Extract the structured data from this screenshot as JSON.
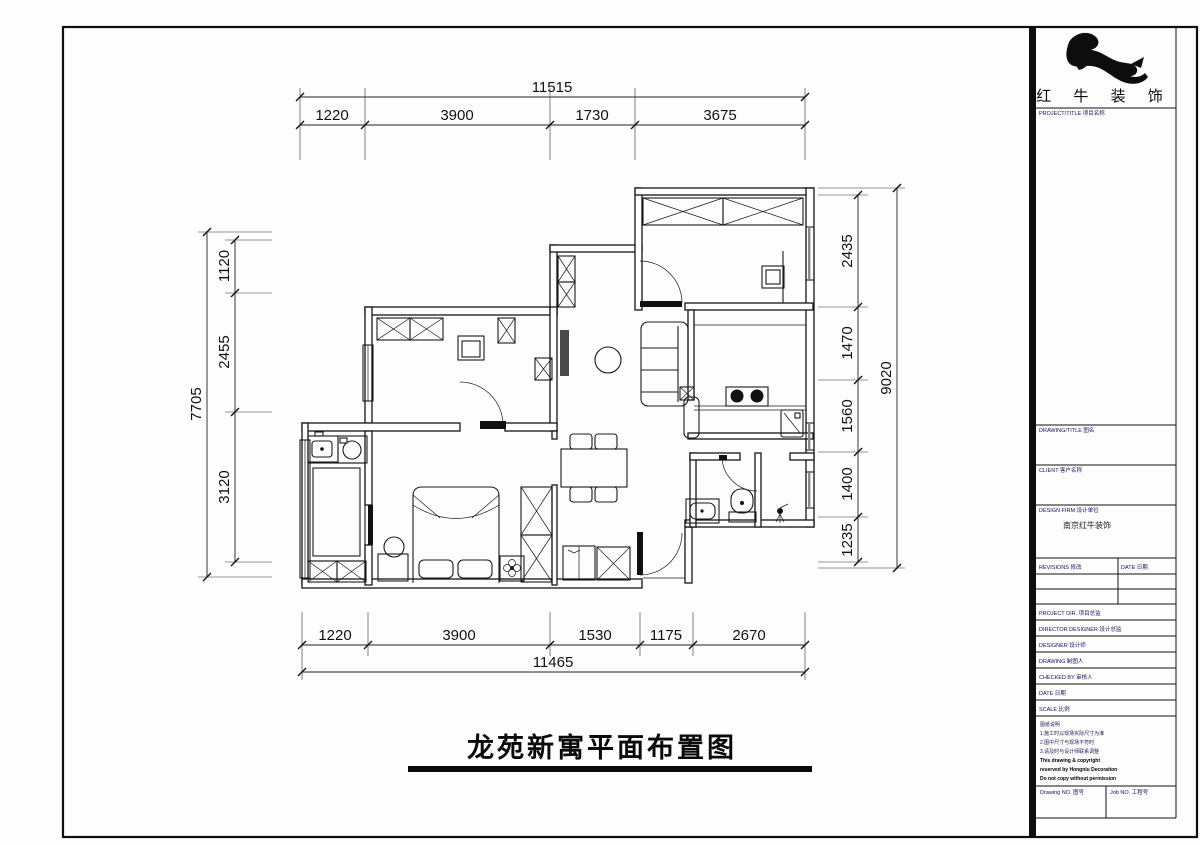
{
  "plan_title": "龙苑新寓平面布置图",
  "dims": {
    "top": {
      "total": "11515",
      "segments": [
        "1220",
        "3900",
        "1730",
        "3675"
      ]
    },
    "bottom": {
      "total": "11465",
      "segments": [
        "1220",
        "3900",
        "1530",
        "1175",
        "2670"
      ]
    },
    "left": {
      "total": "7705",
      "segments": [
        "1120",
        "2455",
        "3120"
      ]
    },
    "right": {
      "total": "9020",
      "segments": [
        "2435",
        "1470",
        "1560",
        "1400",
        "1235"
      ]
    }
  },
  "title_block": {
    "brand_text": "红 牛 装 饰",
    "project_title_label": "PROJECT/TITLE 项目名称",
    "drawing_title_label": "DRAWING/TITLE 图名",
    "client_label": "CLIENT 客户名称",
    "design_firm_label": "DESIGN FIRM 设计单位",
    "design_firm_value": "南京红牛装饰",
    "revisions_label": "REVISIONS 修改",
    "date_col_label": "DATE 日期",
    "personnel": [
      "PROJECT DIR. 项目总监",
      "DIRECTOR DESIGNER 设计总监",
      "DESIGNER 设计师",
      "DRAWING 制图人",
      "CHECKED BY 审核人",
      "DATE 日期",
      "SCALE 比例"
    ],
    "notes": [
      "图纸说明",
      "1.施工时以现场实际尺寸为准",
      "2.图中尺寸与现场不符时",
      "3.请及时与设计师联系调整",
      "This drawing & copyright",
      "reserved by Hongniu Decoration",
      "Do not copy without permission"
    ],
    "drawing_no_label": "Drawing NO. 图号",
    "job_no_label": "Job NO. 工程号"
  }
}
